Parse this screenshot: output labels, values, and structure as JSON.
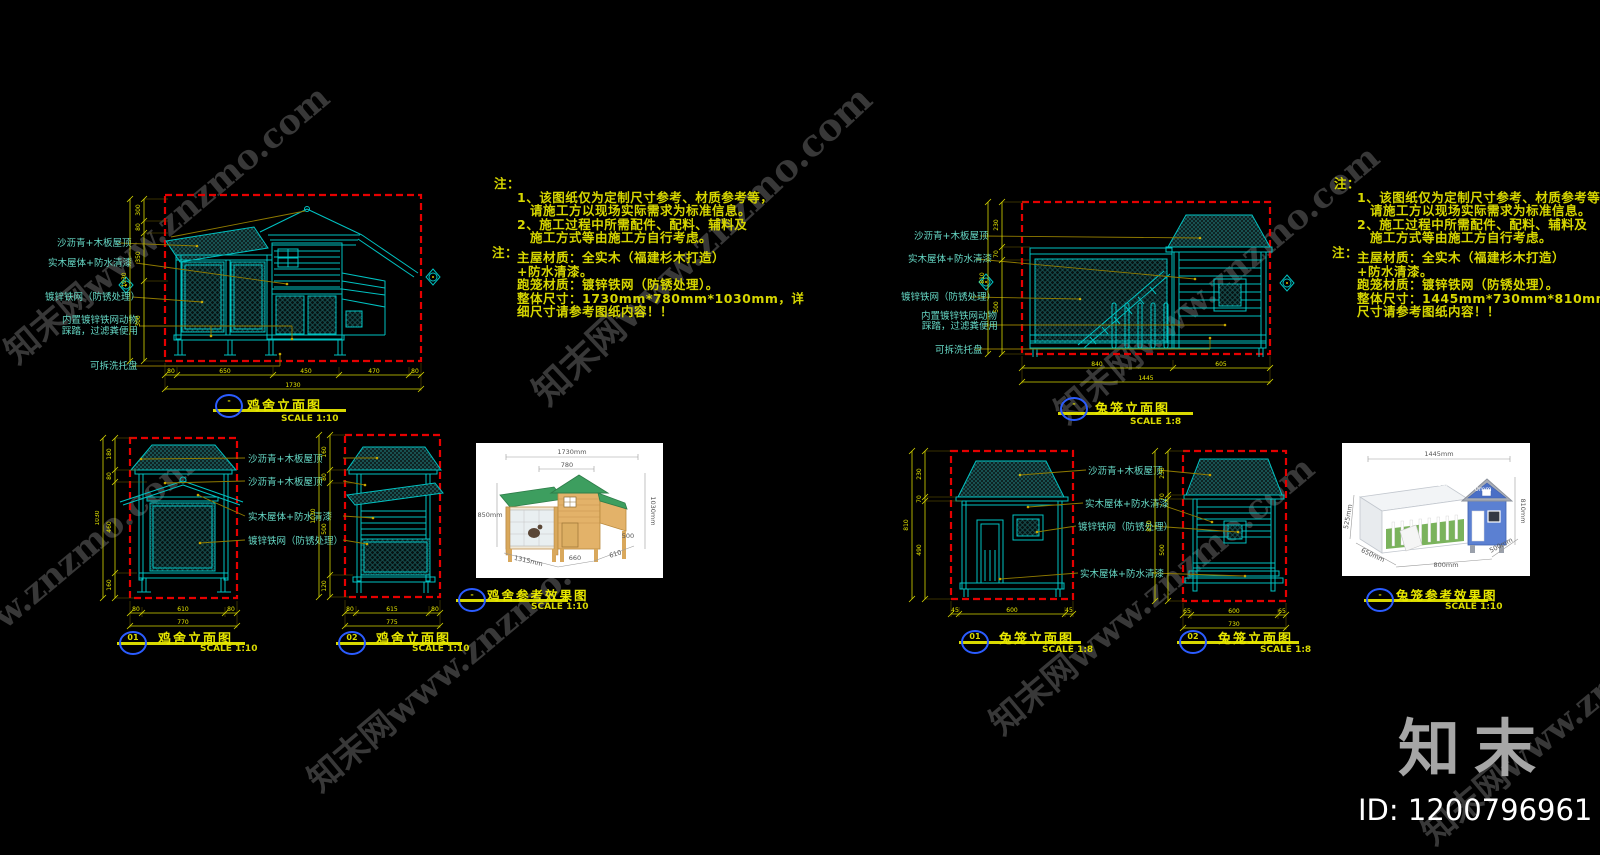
{
  "brand": {
    "logo": "知末",
    "id_text": "ID: 1200796961",
    "watermark": "知末网www.znzmo.com"
  },
  "labels": {
    "roof": "沙沥青+木板屋顶",
    "wood": "实木屋体+防水清漆",
    "mesh": "镀锌铁网（防锈处理）",
    "inner1": "内置镀锌铁网动物",
    "inner2": "踩踏，过滤粪便用",
    "tray": "可拆洗托盘"
  },
  "titles": {
    "coop_elev": "鸡舍立面图",
    "rabbit_elev": "兔笼立面图",
    "coop_photo": "鸡舍参考效果图",
    "rabbit_photo": "兔笼参考效果图",
    "scale10": "SCALE 1:10",
    "scale8": "SCALE 1:8",
    "ref_dash": "-",
    "ref_01": "01",
    "ref_02": "02"
  },
  "notes_left": {
    "h1": "注：",
    "r1a": "1、该图纸仅为定制尺寸参考、材质参考等，",
    "r1b": "请施工方以现场实际需求为标准信息。",
    "r2a": "2、施工过程中所需配件、配料、辅料及",
    "r2b": "施工方式等由施工方自行考虑。",
    "h2": "注：",
    "m1": "主屋材质：全实木（福建杉木打造）",
    "m2": "+防水清漆。",
    "m3": "跑笼材质：镀锌铁网（防锈处理）。",
    "m4": "整体尺寸：1730mm*780mm*1030mm，详",
    "m5": "细尺寸请参考图纸内容！！"
  },
  "notes_right": {
    "h1": "注：",
    "r1a": "1、该图纸仅为定制尺寸参考、材质参考等，",
    "r1b": "请施工方以现场实际需求为标准信息。",
    "r2a": "2、施工过程中所需配件、配料、辅料及",
    "r2b": "施工方式等由施工方自行考虑。",
    "h2": "注：",
    "m1": "主屋材质：全实木（福建杉木打造）",
    "m2": "+防水清漆。",
    "m3": "跑笼材质：镀锌铁网（防锈处理）。",
    "m4": "整体尺寸：1445mm*730mm*810mm，详细",
    "m5": "尺寸请参考图纸内容！！"
  },
  "dims": {
    "A": {
      "v0": "300",
      "v1": "80",
      "v2": "350",
      "v3": "300",
      "vt": "1030",
      "b0": "80",
      "b1": "650",
      "b2": "450",
      "b3": "470",
      "b4": "80",
      "bt": "1730"
    },
    "B": {
      "v0": "230",
      "v1": "70",
      "v2": "500",
      "vt": "810",
      "b0": "840",
      "b1": "605",
      "bt": "1445"
    },
    "C": {
      "v0": "180",
      "v1": "80",
      "v2": "460",
      "v3": "160",
      "vt": "1030",
      "b0": "80",
      "b1": "610",
      "b2": "80",
      "bt": "770"
    },
    "D": {
      "v0": "160",
      "v1": "80",
      "v2": "500",
      "v3": "120",
      "vt": "1030",
      "b0": "80",
      "b1": "615",
      "b2": "80",
      "bt": "775"
    },
    "E": {
      "v0": "230",
      "v1": "70",
      "v2": "490",
      "vt": "810",
      "b0": "45",
      "b1": "600",
      "b2": "45"
    },
    "F": {
      "v0": "230",
      "v1": "70",
      "v2": "500",
      "vt": "810",
      "b0": "65",
      "b1": "600",
      "b2": "65",
      "bt": "730"
    }
  },
  "photo1": {
    "dims": {
      "total": "1730mm",
      "house": "780",
      "left": "850mm",
      "right": "1030mm",
      "nest": "500",
      "d1": "1315mm",
      "d2": "660",
      "d3": "610"
    }
  },
  "photo2": {
    "dims": {
      "total": "1445mm",
      "roof": "730mm",
      "roof2": "470mm",
      "right": "810mm",
      "left": "525mm",
      "d1": "650mm",
      "d2": "800mm",
      "d3": "500mm"
    }
  }
}
